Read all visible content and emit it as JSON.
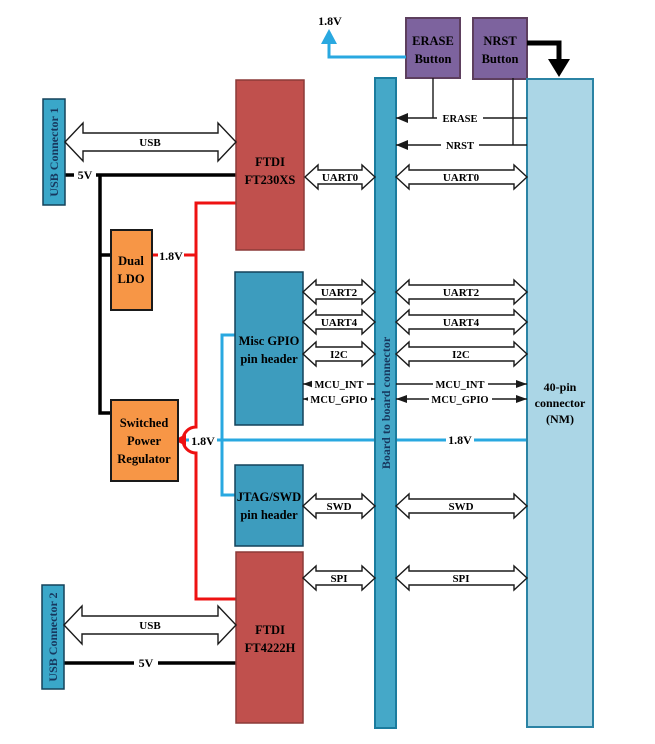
{
  "diagram_title": "USB / FTDI board interconnect block diagram",
  "colors": {
    "usb_connector_fill": "#3aa7c9",
    "pin_header_fill": "#3d9cbe",
    "board_connector_fill": "#45a8c8",
    "connector_40pin_fill": "#abd6e6",
    "ftdi_fill": "#c0504d",
    "regulator_fill": "#f79646",
    "button_fill": "#7d639e",
    "wire_red": "#ee1111",
    "wire_cyan": "#29a8e0",
    "wire_black": "#000000"
  },
  "blocks": {
    "usb_connector_1": {
      "label": "USB Connector 1"
    },
    "usb_connector_2": {
      "label": "USB Connector 2"
    },
    "ftdi_ft230xs": {
      "lines": [
        "FTDI",
        "FT230XS"
      ]
    },
    "ftdi_ft4222h": {
      "lines": [
        "FTDI",
        "FT4222H"
      ]
    },
    "dual_ldo": {
      "lines": [
        "Dual",
        "LDO"
      ]
    },
    "switched_power_regulator": {
      "lines": [
        "Switched",
        "Power",
        "Regulator"
      ]
    },
    "misc_gpio_header": {
      "lines": [
        "Misc GPIO",
        "pin header"
      ]
    },
    "jtag_swd_header": {
      "lines": [
        "JTAG/SWD",
        "pin header"
      ]
    },
    "erase_button": {
      "lines": [
        "ERASE",
        "Button"
      ]
    },
    "nrst_button": {
      "lines": [
        "NRST",
        "Button"
      ]
    },
    "board_to_board": {
      "label": "Board to board connector"
    },
    "connector_40pin": {
      "lines": [
        "40-pin",
        "connector",
        "(NM)"
      ]
    }
  },
  "buses": {
    "usb_top": "USB",
    "usb_bottom": "USB",
    "uart0_left": "UART0",
    "uart0_right": "UART0",
    "uart2_left": "UART2",
    "uart2_right": "UART2",
    "uart4_left": "UART4",
    "uart4_right": "UART4",
    "i2c_left": "I2C",
    "i2c_right": "I2C",
    "swd_left": "SWD",
    "swd_right": "SWD",
    "spi_left": "SPI",
    "spi_right": "SPI"
  },
  "signals": {
    "erase": "ERASE",
    "nrst": "NRST",
    "mcu_int_left": "MCU_INT",
    "mcu_int_right": "MCU_INT",
    "mcu_gpio_left": "MCU_GPIO",
    "mcu_gpio_right": "MCU_GPIO"
  },
  "power": {
    "v5_usb1": "5V",
    "v5_usb2": "5V",
    "v18_top_rail": "1.8V",
    "v18_ldo": "1.8V",
    "v18_rail_left": "1.8V",
    "v18_rail_right": "1.8V"
  }
}
